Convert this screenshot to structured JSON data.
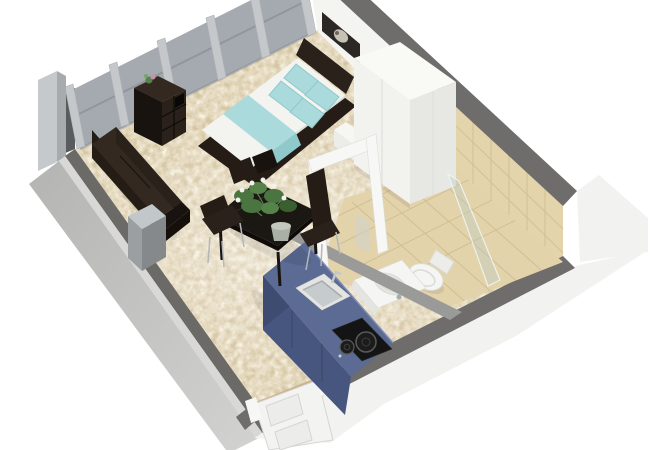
{
  "scene": {
    "type": "3d-floorplan-render",
    "subject": "studio apartment",
    "view": "cutaway isometric from above",
    "background": "#ffffff"
  },
  "colors": {
    "carpet": "#d5c5a2",
    "tile": "#e4d4ac",
    "tile_floor": "#e3d3ab",
    "grout": "#d0bd92",
    "grout_floor": "#cfbc90",
    "wall_white": "#f4f4f1",
    "wall_top_gray": "#6e6d6b",
    "ext_white": "#f2f2f0",
    "ext_left_inner": "#6b6a67",
    "ext_left_light": "#d8d8d6",
    "ext_left_face": "#b9b9b7",
    "wall_return": "#595c5e",
    "glass": "#9da4a9",
    "glass_rail": "#7e8489",
    "pillar": "#c5c8cb",
    "pillar_stroke": "#aeb2b5",
    "corner_post": "#c6c9cc",
    "corner_post_side": "#a7abae",
    "furn_dark": "#241c15",
    "furn_dark2": "#2a211a",
    "furn_darkest": "#191310",
    "furn_mid": "#342920",
    "mattress": "#f3f3ef",
    "teal": "#aadadc",
    "teal_dark": "#8fc9cc",
    "white_furn": "#f6f6f3",
    "white_furn_shade": "#ecece9",
    "white_furn_side": "#e0e0dd",
    "wardrobe_top": "#f9f9f6",
    "wardrobe_front": "#f2f2ef",
    "wardrobe_side": "#e7e7e4",
    "seam": "#dcdcd9",
    "frame_white": "#f7f7f5",
    "fixture_white": "#f5f6f4",
    "fixture_shade": "#e4e4e0",
    "fixture_stroke": "#d9dbd7",
    "steel": "#c2c7c9",
    "steel_dark": "#a6acae",
    "basin_gray": "#c6cbcd",
    "counter_top": "#5b6b94",
    "counter_front": "#47567e",
    "counter_end": "#3e4c72",
    "counter_seam": "#394767",
    "counter_edge": "#7e8db5",
    "cooktop": "#141414",
    "burner": "#1c1c1c",
    "burner_ring": "#5a5a5a",
    "table_top": "#1b1713",
    "table_edge": "#0e0b09",
    "leg_silver": "#b2b7ba",
    "plant_green": "#4a7540",
    "plant_green_light": "#55834a",
    "plant_green_dark": "#3a6030",
    "flower_white": "#f1f3ec",
    "pot": "#a9b0a6",
    "pot_rim": "#c2c8bd",
    "door_white": "#f3f3f1",
    "door_panel": "#ececea",
    "door_stroke": "#d5d5d2",
    "threshold": "#c9b28c",
    "partition": "#9a9a98",
    "shower_glass_fill": "rgba(186,202,196,0.38)",
    "shower_glass_stroke": "rgba(240,248,244,0.85)",
    "mirror": "#ccd4d2",
    "picture_dark": "#2b2724",
    "picture_flower": "#d8d3c6",
    "shadow": "rgba(0,0,0,0.08)"
  },
  "objects": [
    {
      "name": "glass-window-wall",
      "area": "north-west"
    },
    {
      "name": "cube-shelf",
      "area": "north-west",
      "decor": "small-plant"
    },
    {
      "name": "sofa",
      "area": "west"
    },
    {
      "name": "side-table",
      "area": "west"
    },
    {
      "name": "double-bed",
      "area": "north",
      "bedding": [
        "white-duvet",
        "teal-runner",
        "4-teal-pillows"
      ]
    },
    {
      "name": "nightstand",
      "area": "north"
    },
    {
      "name": "wall-picture",
      "area": "north"
    },
    {
      "name": "wardrobe",
      "area": "north-east"
    },
    {
      "name": "bathroom",
      "area": "east",
      "fixtures": [
        "washbasin",
        "toilet",
        "shower-glass",
        "tiled-walls",
        "doorframe"
      ]
    },
    {
      "name": "kitchen-unit",
      "area": "south-east",
      "features": [
        "inset-sink",
        "two-burner-cooktop"
      ]
    },
    {
      "name": "dining-table",
      "area": "center",
      "chairs": 4,
      "decor": "potted-plant"
    },
    {
      "name": "entry-door",
      "area": "south",
      "state": "open"
    }
  ]
}
